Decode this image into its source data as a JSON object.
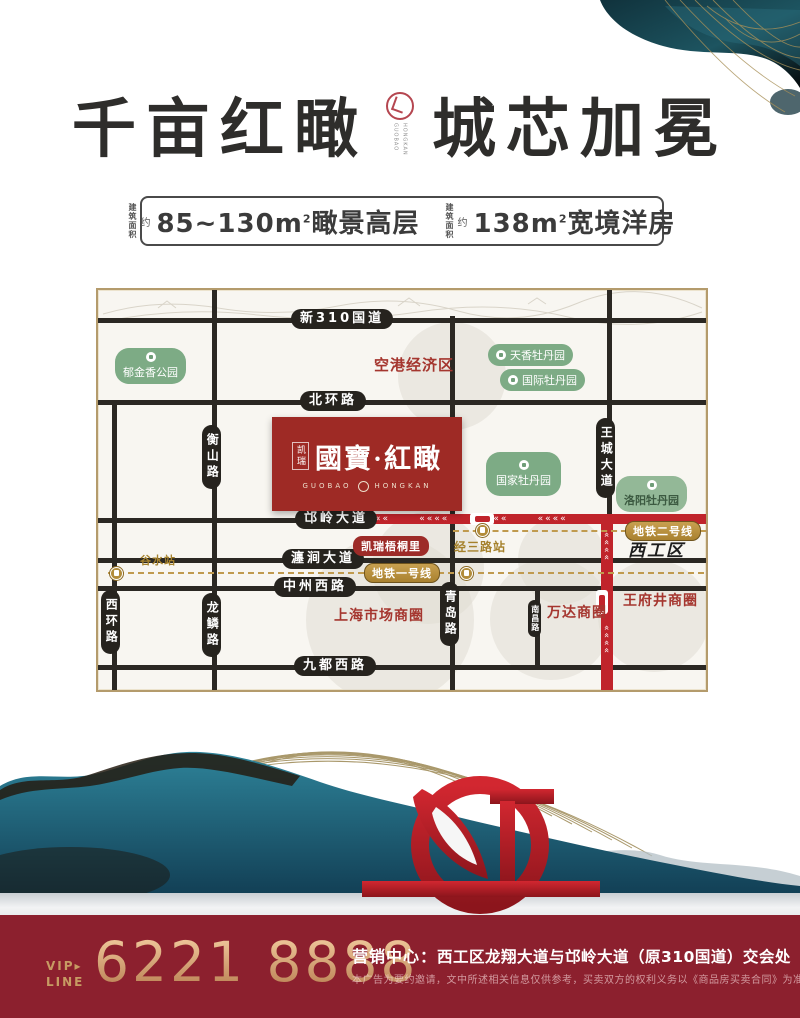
{
  "header": {
    "title_left": "千亩红瞰",
    "title_right": "城芯加冕",
    "seal_letters_left": "GUOBAO",
    "seal_letters_right": "HONGKAN"
  },
  "specs": {
    "prefix_line1": "建筑",
    "prefix_line2": "面积",
    "approx": "约",
    "items": [
      {
        "area": "85~130m",
        "sup": "2",
        "type": "瞰景高层"
      },
      {
        "area": "138m",
        "sup": "2",
        "type": "宽境洋房"
      }
    ]
  },
  "map": {
    "h_roads": [
      {
        "label": "新310国道"
      },
      {
        "label": "北环路"
      },
      {
        "label": "邙岭大道"
      },
      {
        "label": "瀍涧大道"
      },
      {
        "label": "中州西路"
      },
      {
        "label": "九都西路"
      }
    ],
    "v_roads": [
      {
        "label": "西环路"
      },
      {
        "label": "衡山路"
      },
      {
        "label": "龙鳞路"
      },
      {
        "label": "华山路"
      },
      {
        "label": "青岛路"
      },
      {
        "label": "王城大道"
      },
      {
        "label": "南昌路"
      }
    ],
    "parks": [
      {
        "name": "郁金香公园"
      },
      {
        "name": "天香牡丹园"
      },
      {
        "name": "国际牡丹园"
      },
      {
        "name": "国家牡丹园"
      },
      {
        "name": "洛阳牡丹园"
      }
    ],
    "zones": {
      "airport": "空港经济区",
      "shanghai": "上海市场商圈",
      "wanda": "万达商圈",
      "wangfujing": "王府井商圈",
      "xigong": "西工区"
    },
    "poi_red": "凯瑞梧桐里",
    "metro": {
      "line1": {
        "label": "地铁一号线",
        "station": "谷水站"
      },
      "line2": {
        "label": "地铁二号线",
        "station": "经三路站"
      }
    },
    "project": {
      "brand": "凯瑞",
      "name": "國寶·紅瞰",
      "latin_left": "GUOBAO",
      "latin_right": "HONGKAN"
    },
    "arrows_h": "««««      ««««      ««««      ««««",
    "arrows_v": "««««"
  },
  "footer": {
    "vip_line1": "VIP▸",
    "vip_line2": "LINE",
    "phone": "6221 8888",
    "center_label": "营销中心：",
    "address": "西工区龙翔大道与邙岭大道（原310国道）交会处",
    "disclaimer": "本广告为要约邀请，文中所述相关信息仅供参考，买卖双方的权利义务以《商品房买卖合同》为准。"
  },
  "colors": {
    "brand_red": "#9e2a25",
    "route_red": "#c0242b",
    "road_black": "#2b2823",
    "park_green": "#7dab85",
    "metro_gold": "#c09a4e",
    "footer_bg": "#8c202e",
    "footer_gold": "#c79b63"
  }
}
